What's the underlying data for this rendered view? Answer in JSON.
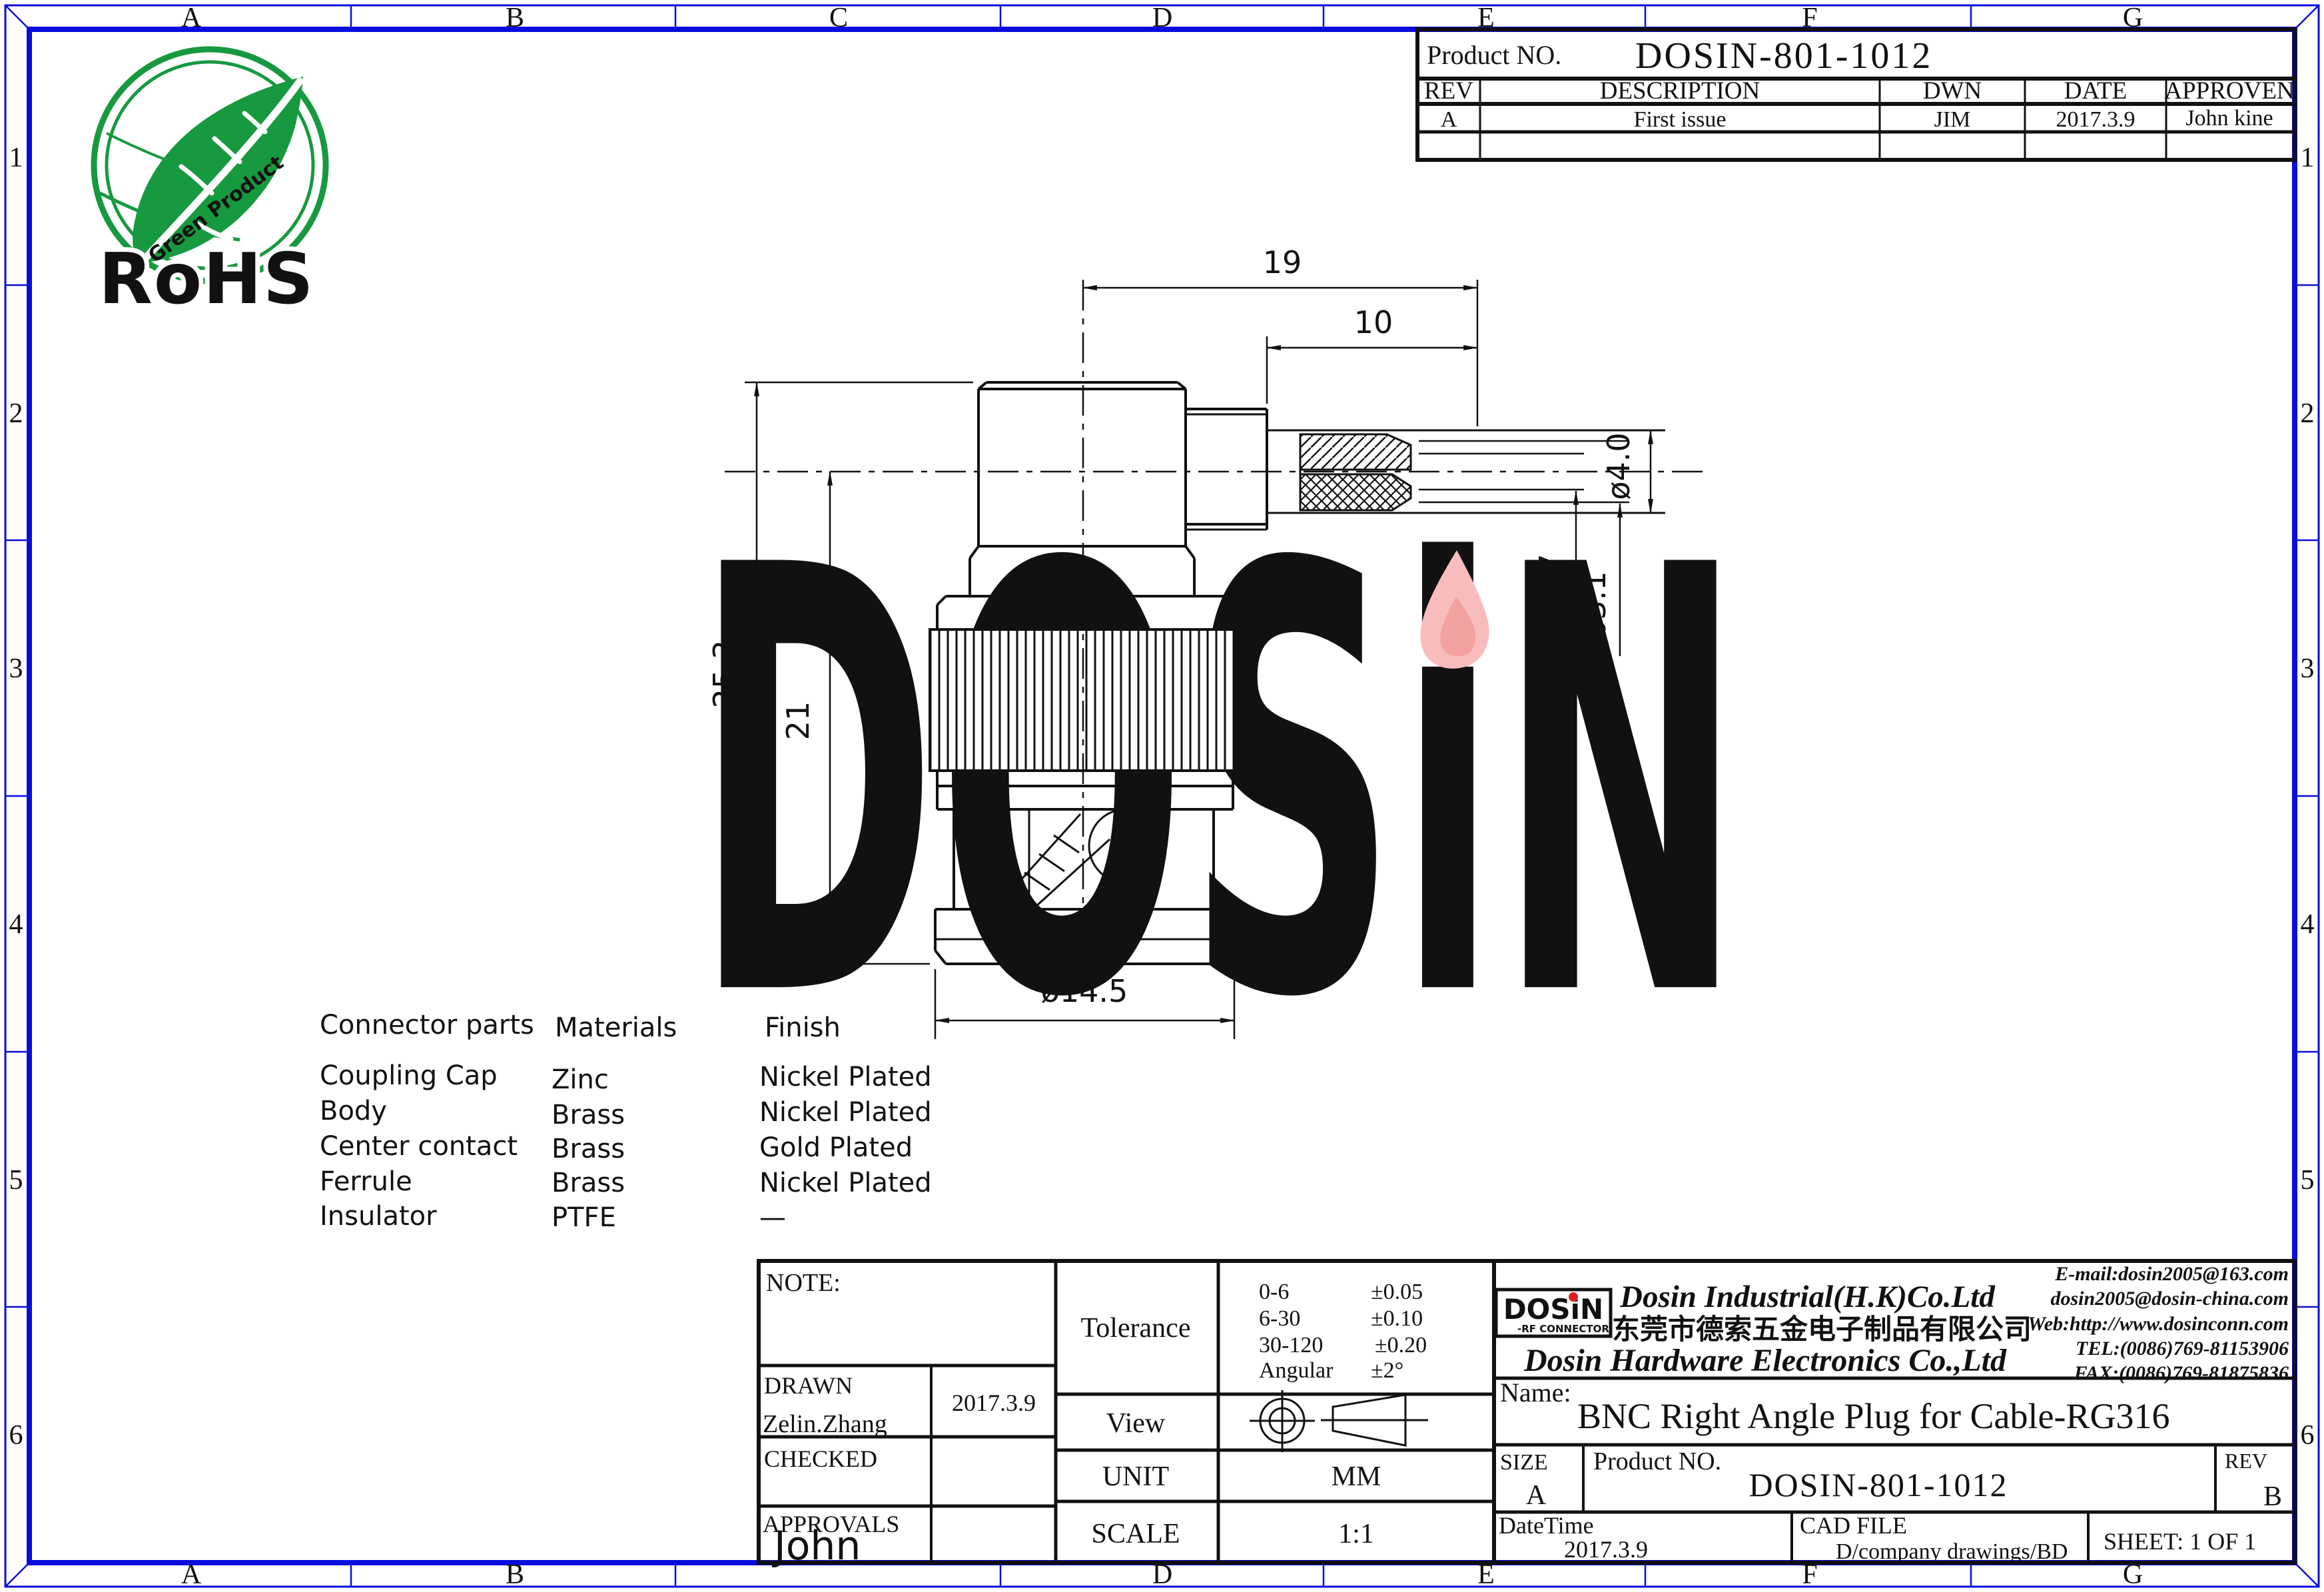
{
  "palette": {
    "frame_blue": "#0b0bdd",
    "line_black": "#111111",
    "rohs_green": "#17993f",
    "watermark_lavender": "#c9c9ee",
    "flame_pink": "#f8bcbc",
    "flame_red": "#f09090",
    "logo_blue": "#1616cf",
    "logo_red": "#e02020",
    "cn_magenta": "#ff00ff"
  },
  "grid": {
    "top": [
      "A",
      "B",
      "C",
      "D",
      "E",
      "F",
      "G"
    ],
    "bottom": [
      "A",
      "B",
      "",
      "D",
      "E",
      "F",
      "G"
    ],
    "left": [
      "1",
      "2",
      "3",
      "4",
      "5",
      "6"
    ],
    "right": [
      "1",
      "2",
      "3",
      "4",
      "5",
      "6"
    ]
  },
  "rohs": {
    "title": "RoHS",
    "subtitle": "Green Product"
  },
  "revision_table": {
    "product_label": "Product NO.",
    "product_no": "DOSIN-801-1012",
    "col_rev": "REV",
    "col_description": "DESCRIPTION",
    "col_dwn": "DWN",
    "col_date": "DATE",
    "col_approven": "APPROVEN",
    "row": {
      "rev": "A",
      "description": "First issue",
      "dwn": "JIM",
      "date": "2017.3.9",
      "approven": "John kine"
    }
  },
  "watermark": {
    "text": "DOSiN"
  },
  "dimensions": {
    "length_total": "19",
    "length_ferrule": "10",
    "height_total": "25.3",
    "height_body": "21",
    "dia_pin": "ø1.7",
    "dia_insulator": "ø3.1",
    "dia_cable": "ø4.0",
    "dia_cap": "ø14.5"
  },
  "materials_table": {
    "col_parts": "Connector parts",
    "col_materials": "Materials",
    "col_finish": "Finish",
    "rows": [
      [
        "Coupling Cap",
        "Zinc",
        "Nickel Plated"
      ],
      [
        "Body",
        "Brass",
        "Nickel Plated"
      ],
      [
        "Center contact",
        "Brass",
        "Gold Plated"
      ],
      [
        "Ferrule",
        "Brass",
        "Nickel Plated"
      ],
      [
        "Insulator",
        "PTFE",
        "—"
      ]
    ]
  },
  "title_block": {
    "note_label": "NOTE:",
    "tolerance_label": "Tolerance",
    "tolerance_rows": [
      {
        "range": "0-6",
        "value": "±0.05"
      },
      {
        "range": "6-30",
        "value": "±0.10"
      },
      {
        "range": "30-120",
        "value": "±0.20"
      },
      {
        "range": "Angular",
        "value": "±2°"
      }
    ],
    "view_label": "View",
    "unit_label": "UNIT",
    "unit_value": "MM",
    "scale_label": "SCALE",
    "scale_value": "1:1",
    "drawn_label": "DRAWN",
    "drawn_name": "Zelin.Zhang",
    "drawn_date": "2017.3.9",
    "checked_label": "CHECKED",
    "approvals_label": "APPROVALS",
    "approvals_name": "John"
  },
  "company": {
    "logo_text": "DOSiN",
    "logo_sub": "-RF CONNECTOR",
    "name_en": "Dosin Industrial(H.K)Co.Ltd",
    "name_cn": "东莞市德索五金电子制品有限公司",
    "name_en2": "Dosin Hardware Electronics Co.,Ltd",
    "email1": "E-mail:dosin2005@163.com",
    "email2": "dosin2005@dosin-china.com",
    "web": "Web:http://www.dosinconn.com",
    "tel": "TEL:(0086)769-81153906",
    "fax": "FAX:(0086)769-81875836"
  },
  "part_info": {
    "name_label": "Name:",
    "name_value": "BNC Right Angle Plug for Cable-RG316",
    "size_label": "SIZE",
    "size_value": "A",
    "product_label": "Product NO.",
    "product_no": "DOSIN-801-1012",
    "rev_label": "REV",
    "rev_value": "B",
    "datetime_label": "DateTime",
    "datetime_value": "2017.3.9",
    "cadfile_label": "CAD FILE",
    "cadfile_value": "D/company drawings/BD",
    "sheet_label": "SHEET:  1 OF 1"
  }
}
